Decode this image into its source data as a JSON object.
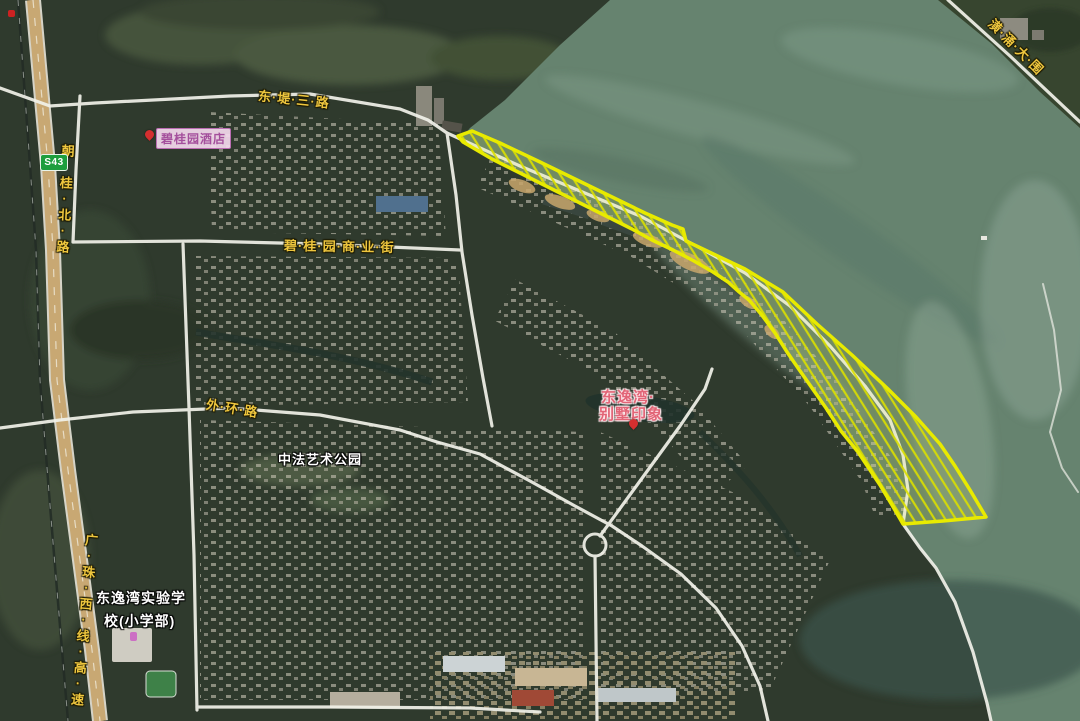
{
  "map": {
    "road_labels": {
      "dongdi": "东·堤·三·路",
      "chaogui": "朝·桂·北·路",
      "shangyejie": "碧·桂·园·商·业·街",
      "waihuan": "外·环·路",
      "gaosu": "广·珠·西·线·高·速",
      "dawei": "潢·涌·大·围"
    },
    "shield": {
      "code": "S43"
    },
    "poi": {
      "park": "中法艺术公园",
      "school1": "东逸湾实验学",
      "school2": "校(小学部)",
      "hotel": "碧桂园酒店",
      "estate1": "东逸湾·",
      "estate2": "别墅印象"
    },
    "colors": {
      "water": "#66836f",
      "land": "#2f3a2d",
      "highway": "#c8a873",
      "road": "#f2f2ea",
      "highlight_outline": "#e8ea00",
      "highlight_hatch": "#dce000",
      "road_label": "#eec63e"
    }
  }
}
